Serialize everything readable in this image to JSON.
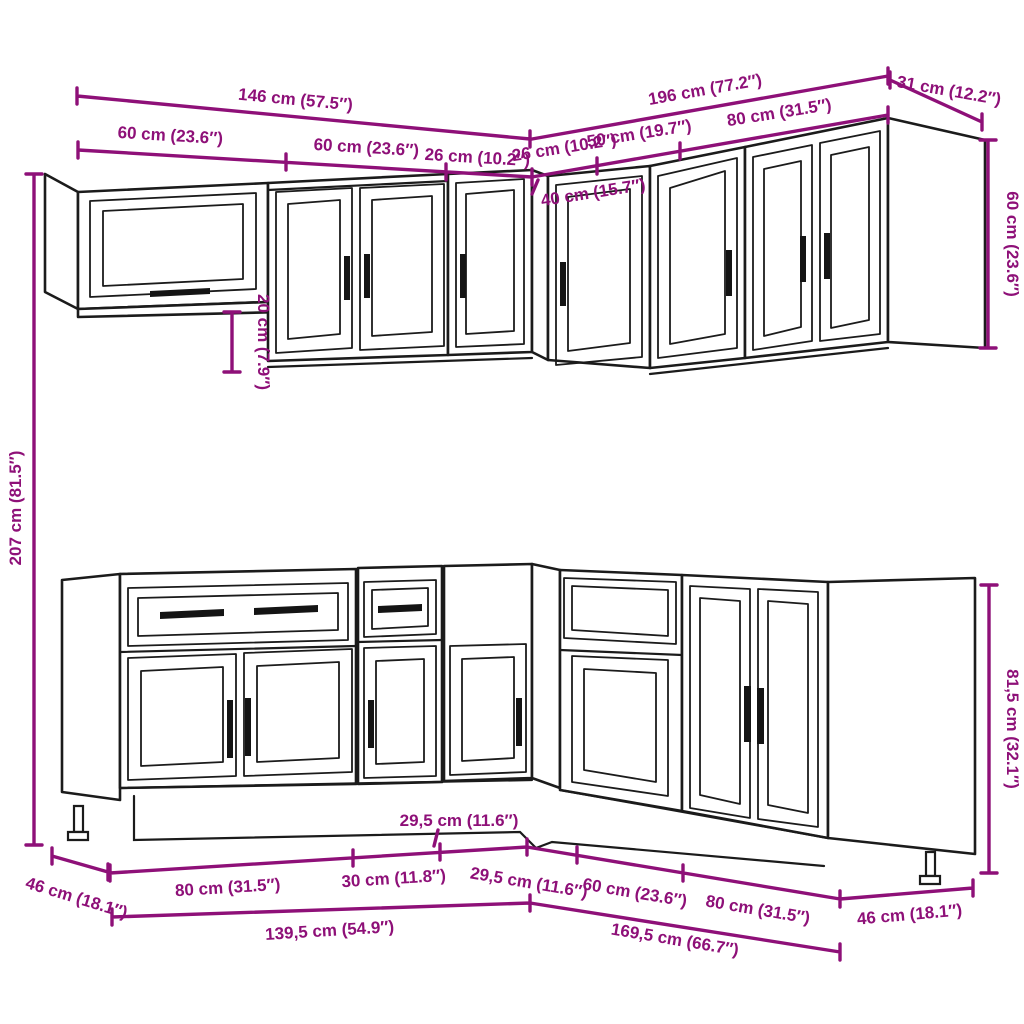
{
  "diagram": {
    "kind": "kitchen-cabinet-set-dimension-diagram",
    "accent_color": "#8E1078",
    "line_color": "#1B1B1B",
    "background_color": "#FFFFFF",
    "rows": {
      "wall_row_units": [
        "glass-door-wall-cabinet",
        "two-door-wall-cabinet",
        "narrow-wall-cabinet",
        "corner-wall-cabinet",
        "single-door-wall-cabinet",
        "two-door-wall-cabinet",
        "end-panel"
      ],
      "base_row_units": [
        "drawer-two-door-base-cabinet",
        "drawer-single-door-base-cabinet",
        "corner-base-cabinet",
        "open-top-base-cabinet",
        "two-door-base-cabinet",
        "end-side-panel"
      ]
    }
  },
  "dims": {
    "d146": "146 cm (57.5″)",
    "d196": "196 cm (77.2″)",
    "d31": "31 cm (12.2″)",
    "d60_wall_a": "60 cm (23.6″)",
    "d60_wall_b": "60 cm (23.6″)",
    "d26_a": "26 cm (10.2″)",
    "d26_b": "26 cm (10.2″)",
    "d50": "50 cm (19.7″)",
    "d80_wall": "80 cm (31.5″)",
    "d40": "40 cm (15.7″)",
    "d60_wall_h": "60 cm (23.6″)",
    "d20": "20 cm (7.9″)",
    "d207": "207 cm (81.5″)",
    "d80_base_l": "80 cm (31.5″)",
    "d30": "30 cm (11.8″)",
    "d29_5_a": "29,5 cm (11.6″)",
    "d29_5_b": "29,5 cm (11.6″)",
    "d60_base": "60 cm (23.6″)",
    "d80_base_r": "80 cm (31.5″)",
    "d46_l": "46 cm (18.1″)",
    "d46_r": "46 cm (18.1″)",
    "d139_5": "139,5 cm (54.9″)",
    "d169_5": "169,5 cm (66.7″)",
    "d81_5": "81,5 cm (32.1″)"
  }
}
